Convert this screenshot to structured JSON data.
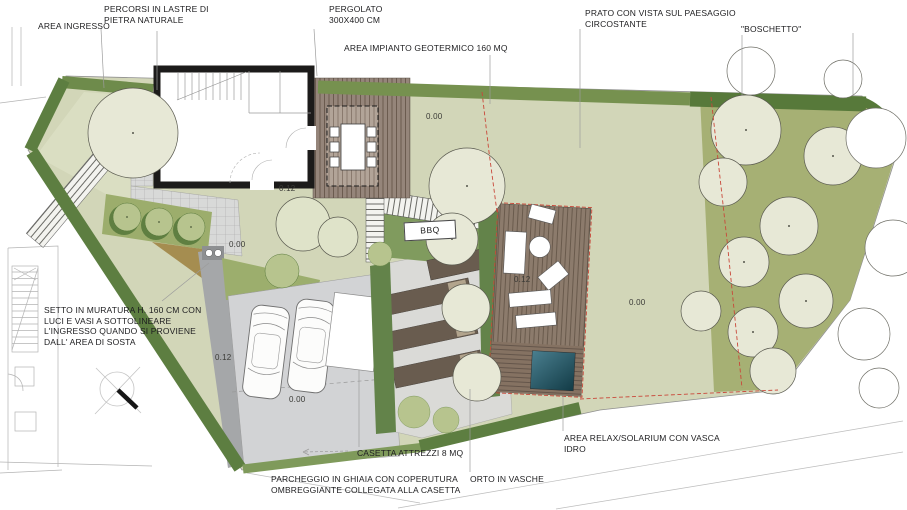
{
  "plan": {
    "labels": {
      "area_ingresso": "AREA INGRESSO",
      "percorsi": "PERCORSI IN LASTRE DI\nPIETRA NATURALE",
      "pergolato": "PERGOLATO\n300X400 CM",
      "impianto_geotermico": "AREA IMPIANTO GEOTERMICO 160 MQ",
      "prato": "PRATO CON VISTA SUL PAESAGGIO\nCIRCOSTANTE",
      "boschetto": "\"BOSCHETTO\"",
      "setto": "SETTO IN MURATURA H. 160 CM CON\nLUCI E VASI A SOTTOLINEARE\nL'INGRESSO QUANDO SI PROVIENE\nDALL' AREA DI SOSTA",
      "casetta": "CASETTA ATTREZZI 8 MQ",
      "parcheggio": "PARCHEGGIO IN GHIAIA CON COPERUTURA\nOMBREGGIANTE COLLEGATA ALLA CASETTA",
      "orto": "ORTO IN VASCHE",
      "relax": "AREA RELAX/SOLARIUM CON VASCA\nIDRO",
      "bbq": "BBQ"
    },
    "markers": [
      {
        "text": "0.00"
      },
      {
        "text": "0.00"
      },
      {
        "text": "0.00"
      },
      {
        "text": "0.00"
      },
      {
        "text": "0.12"
      },
      {
        "text": "0.12"
      },
      {
        "text": "0.12"
      }
    ],
    "colors": {
      "lawn": "#d2d6b8",
      "entrance_lawn": "#dadec2",
      "hedge_dark": "#5d7e41",
      "hedge_medium": "#76914f",
      "boschetto_ground": "#a6b074",
      "tree_canopy": "#e7e8d6",
      "deck_wood": "#93836f",
      "raised_bed": "#695c4f",
      "parking_gray": "#d2d3d5",
      "driveway_gray": "#a5a7a9",
      "ochre": "#a58d50",
      "hot_tub": "#2d6372",
      "red_dashed": "#c9483a",
      "building_wall": "#1c1b1a"
    }
  }
}
